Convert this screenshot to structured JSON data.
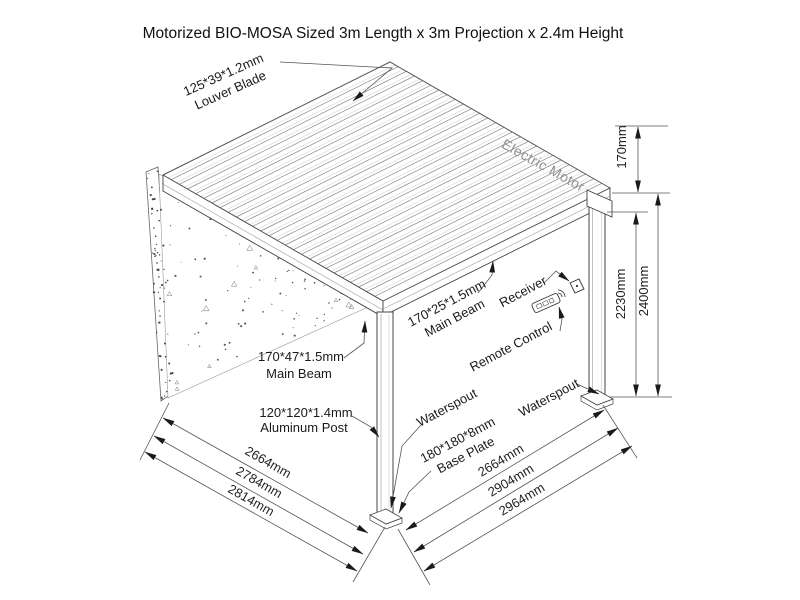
{
  "title": "Motorized BIO-MOSA Sized 3m Length x 3m Projection x 2.4m Height",
  "colors": {
    "line": "#444444",
    "dim_line": "#555555",
    "arrow": "#1a1a1a",
    "motor_text": "#919191"
  },
  "labels": {
    "louver_blade": {
      "line1": "125*39*1.2mm",
      "line2": "Louver Blade"
    },
    "electric_motor": "Electric Motor",
    "main_beam_top": {
      "line1": "170*25*1.5mm",
      "line2": "Main Beam"
    },
    "receiver": "Receiver",
    "remote_control": "Remote Control",
    "main_beam_left": {
      "line1": "170*47*1.5mm",
      "line2": "Main Beam"
    },
    "aluminum_post": {
      "line1": "120*120*1.4mm",
      "line2": "Aluminum Post"
    },
    "waterspout_left": "Waterspout",
    "waterspout_right": "Waterspout",
    "base_plate": {
      "line1": "180*180*8mm",
      "line2": "Base Plate"
    }
  },
  "dimensions": {
    "beam_height": "170mm",
    "post_height": "2230mm",
    "total_height": "2400mm",
    "left_side": [
      "2664mm",
      "2784mm",
      "2814mm"
    ],
    "right_side": [
      "2664mm",
      "2904mm",
      "2964mm"
    ]
  }
}
